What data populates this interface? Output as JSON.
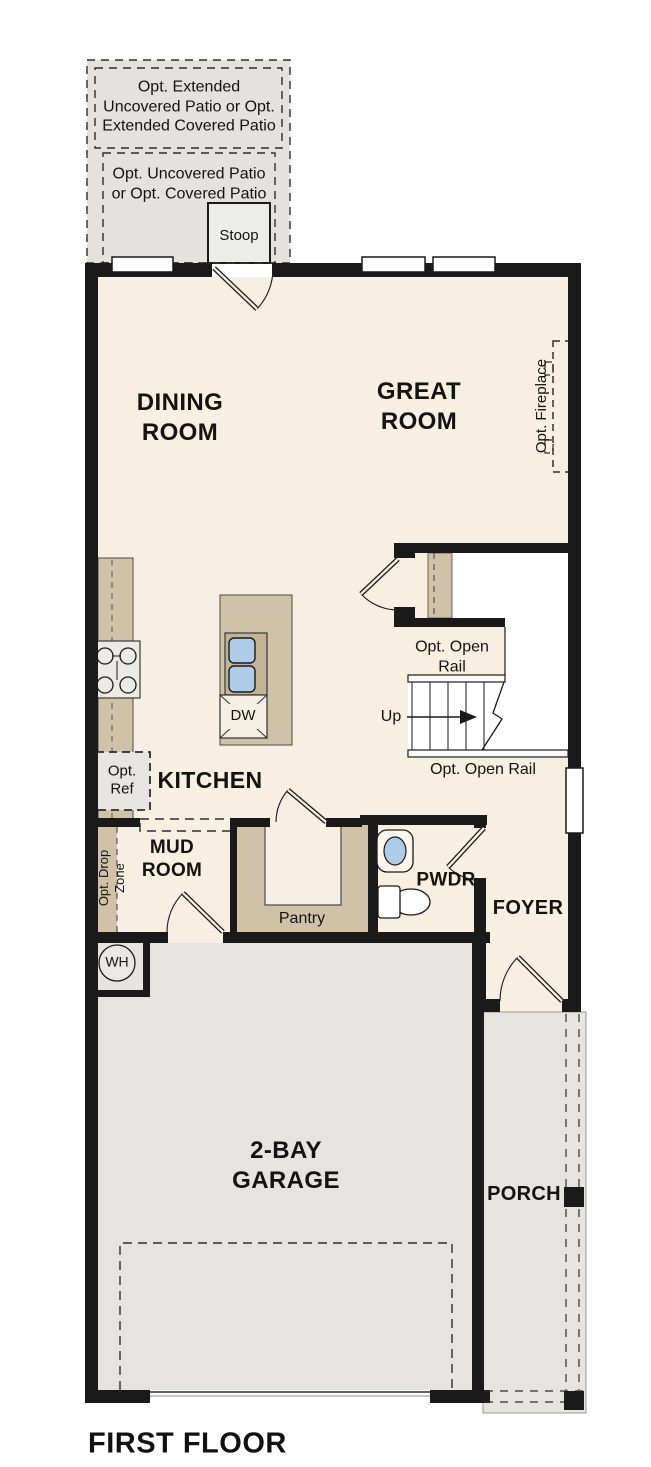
{
  "plan": {
    "title": "FIRST FLOOR",
    "rooms": {
      "dining_room": {
        "label": "DINING\nROOM"
      },
      "great_room": {
        "label": "GREAT\nROOM"
      },
      "kitchen": {
        "label": "KITCHEN"
      },
      "mud_room": {
        "label": "MUD\nROOM"
      },
      "pantry": {
        "label": "Pantry"
      },
      "powder_room": {
        "label": "PWDR"
      },
      "foyer": {
        "label": "FOYER"
      },
      "garage": {
        "label": "2-BAY\nGARAGE"
      },
      "porch": {
        "label": "PORCH"
      },
      "stoop": {
        "label": "Stoop"
      }
    },
    "options": {
      "extended_patio": {
        "label": "Opt. Extended\nUncovered Patio or Opt.\nExtended Covered Patio"
      },
      "patio": {
        "label": "Opt. Uncovered Patio\nor Opt. Covered Patio"
      },
      "fireplace": {
        "label": "Opt. Fireplace"
      },
      "refrigerator": {
        "label": "Opt.\nRef"
      },
      "drop_zone": {
        "label": "Opt. Drop\nZone"
      },
      "open_rail_upper": {
        "label": "Opt. Open\nRail"
      },
      "open_rail_lower": {
        "label": "Opt. Open Rail"
      }
    },
    "fixtures": {
      "stairs_up": {
        "label": "Up"
      },
      "dishwasher": {
        "label": "DW"
      },
      "water_heater": {
        "label": "WH"
      }
    },
    "colors": {
      "floor_cream": "#f7efe2",
      "hard_surface_gray": "#e5e4e1",
      "patio_gray": "#e3e2df",
      "casework_tan": "#cfc2a7",
      "sink_blue": "#aecbe8",
      "wall_black": "#1a1a1a"
    }
  }
}
